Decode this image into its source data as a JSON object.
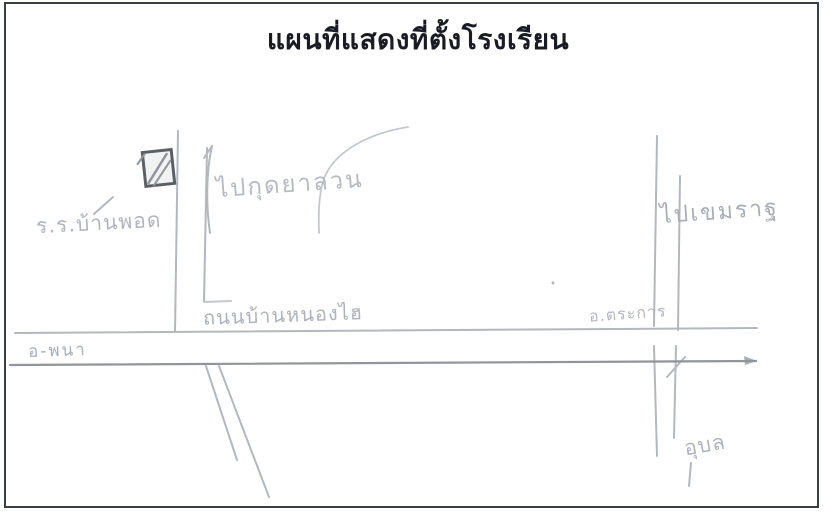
{
  "page": {
    "title": "แผนที่แสดงที่ตั้งโรงเรียน"
  },
  "map": {
    "school_label": "ร.ร.บ้านพอด",
    "north_destination_label": "ไปกุดยาลวน",
    "road_label": "ถนนบ้านหนองไฮ",
    "district_label": "อ.ตระการ",
    "east_destination_label": "ไปเขมราฐ",
    "west_town_label": "อ-พนา",
    "south_town_label": "อุบล",
    "icons": {
      "school_marker": "▨",
      "up_arrow": "↑",
      "down_arrow": "↓"
    },
    "colors": {
      "paper": "#ffffff",
      "frame": "#3b3e44",
      "ink": "#1b1b24",
      "pencil": "#b3b8bd",
      "pencil_light": "#c4c8cc",
      "pencil_dark": "#8f959a",
      "marker": "#5a6066"
    }
  }
}
